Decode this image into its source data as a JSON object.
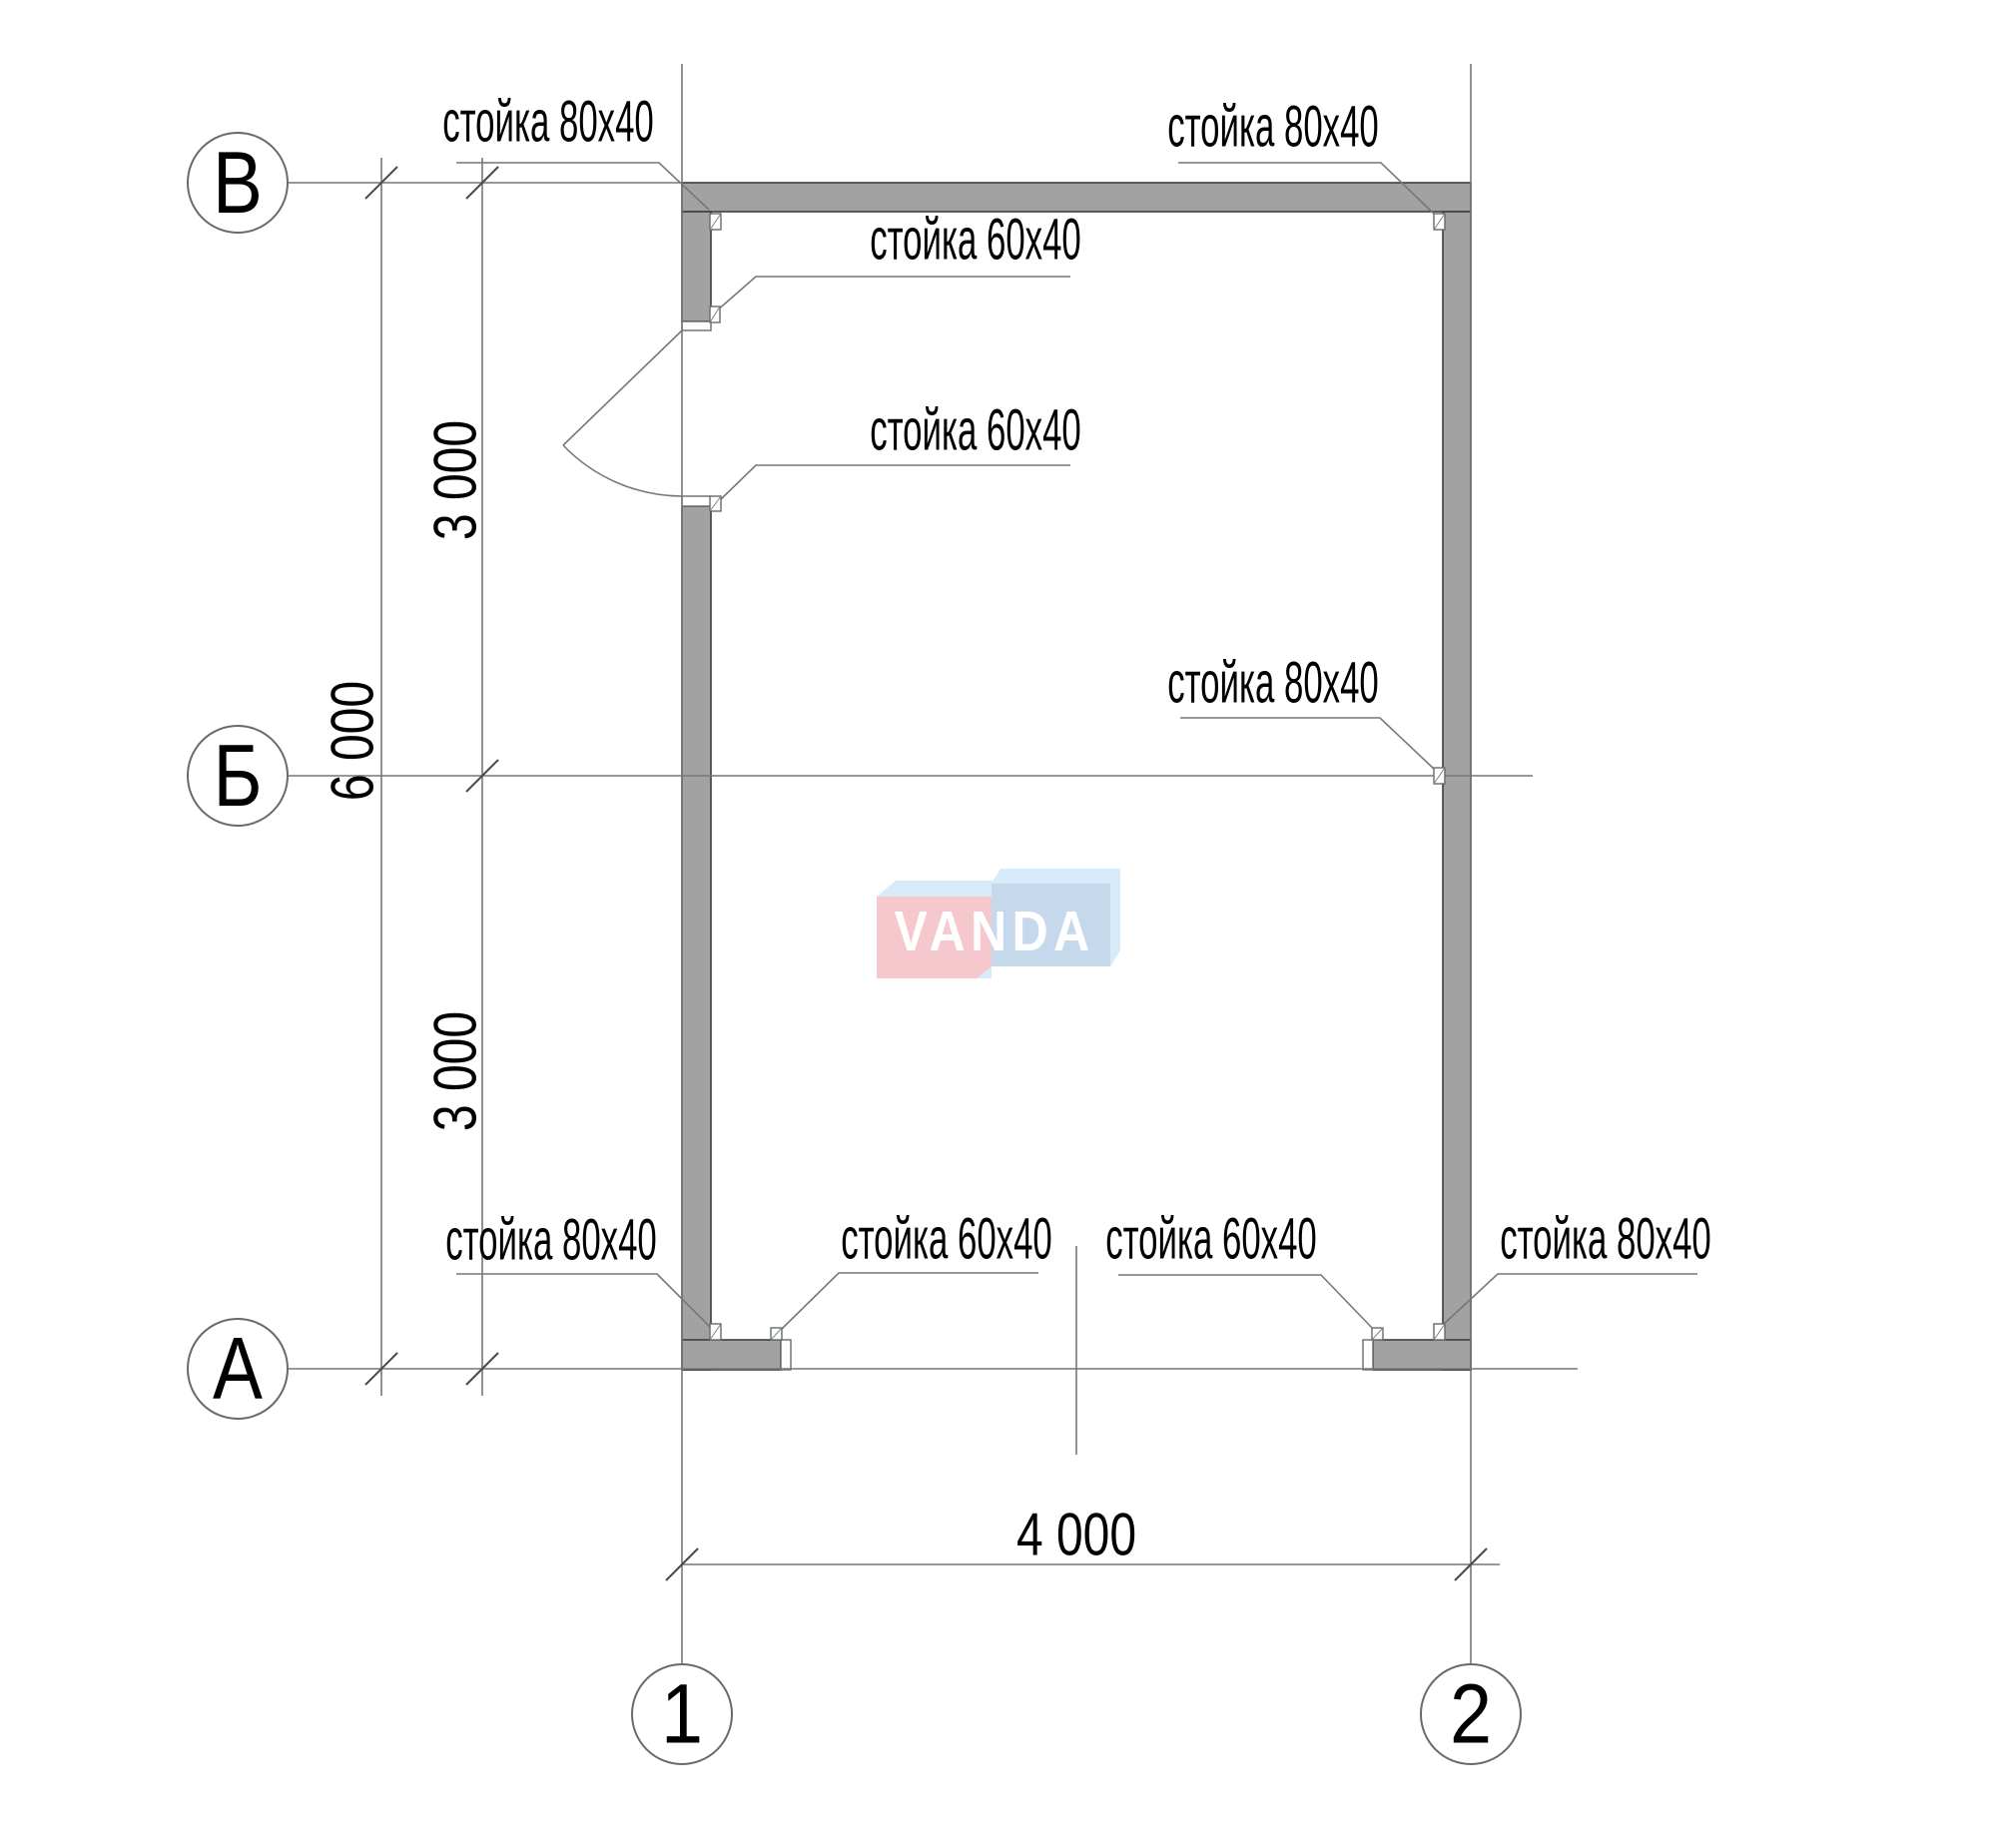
{
  "axes": {
    "horizontal": [
      "В",
      "Б",
      "А"
    ],
    "vertical": [
      "1",
      "2"
    ]
  },
  "dimensions": {
    "top_segment": "3 000",
    "overall_height": "6 000",
    "bottom_segment": "3 000",
    "width": "4 000"
  },
  "annotations": [
    "стойка 80x40",
    "стойка 60x40",
    "стойка 60x40",
    "стойка 80x40",
    "стойка 80x40",
    "стойка 80x40",
    "стойка 60x40",
    "стойка 60x40",
    "стойка 80x40"
  ],
  "watermark": {
    "text": "VANDA"
  },
  "colors": {
    "wall_fill": "#a2a2a2",
    "wall_stroke": "#3f3f3f",
    "line": "#777777",
    "post_stroke": "#6f8c8c",
    "logo_pink": "#f4c8cd",
    "logo_blue": "#c6d9ec",
    "logo_blue_light": "#d8ebfa",
    "logo_text": "#ffffff"
  }
}
